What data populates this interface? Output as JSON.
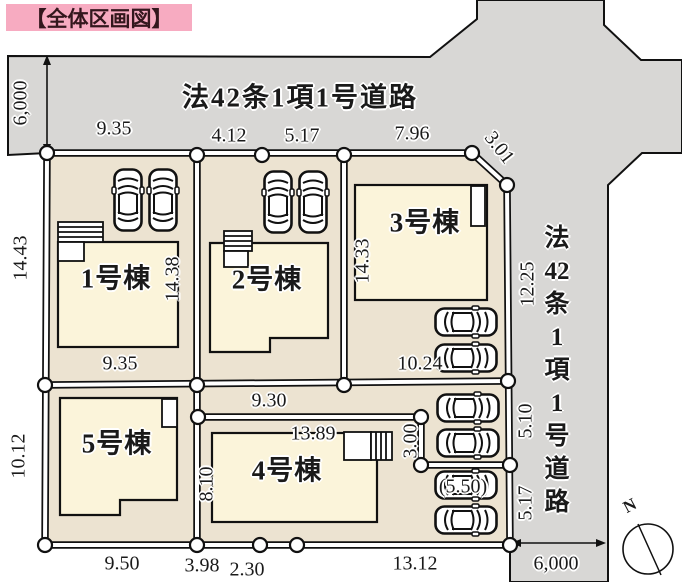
{
  "title": "【全体区画図】",
  "roads": {
    "top": {
      "label": "法42条1項1号道路",
      "width": "6,000"
    },
    "right": {
      "label": "法42条1項1号道路",
      "chars": [
        "法",
        "42",
        "条",
        "1",
        "項",
        "1",
        "号",
        "道",
        "路"
      ],
      "width": "6,000"
    }
  },
  "lots": {
    "lot1": {
      "label": "1号棟"
    },
    "lot2": {
      "label": "2号棟"
    },
    "lot3": {
      "label": "3号棟"
    },
    "lot4": {
      "label": "4号棟"
    },
    "lot5": {
      "label": "5号棟"
    }
  },
  "dimensions": {
    "top": {
      "d1": "9.35",
      "d2": "4.12",
      "d3": "5.17",
      "d4": "7.96",
      "d5": "3.01"
    },
    "left": {
      "d1": "14.43",
      "d2": "10.12"
    },
    "right": {
      "d1": "12.25",
      "d2": "5.10",
      "d3": "5.17"
    },
    "bottom": {
      "d1": "9.50",
      "d2": "3.98",
      "d3": "2.30",
      "d4": "13.12"
    },
    "inner": {
      "lot1_frontage": "9.35",
      "lot1_depth": "14.38",
      "lot3_depth": "14.33",
      "lot3_parking": "10.24",
      "corridor": "9.30",
      "lot4_width": "13.89",
      "lot4_depth": "8.10",
      "parking_depth": "3.00",
      "parking_south": "(5.50)"
    }
  },
  "compass": {
    "north": "N"
  },
  "colors": {
    "road": "#d8d7d5",
    "parcel": "#ece3d1",
    "building": "#fbf4da",
    "title-bg": "#f7abc1"
  }
}
